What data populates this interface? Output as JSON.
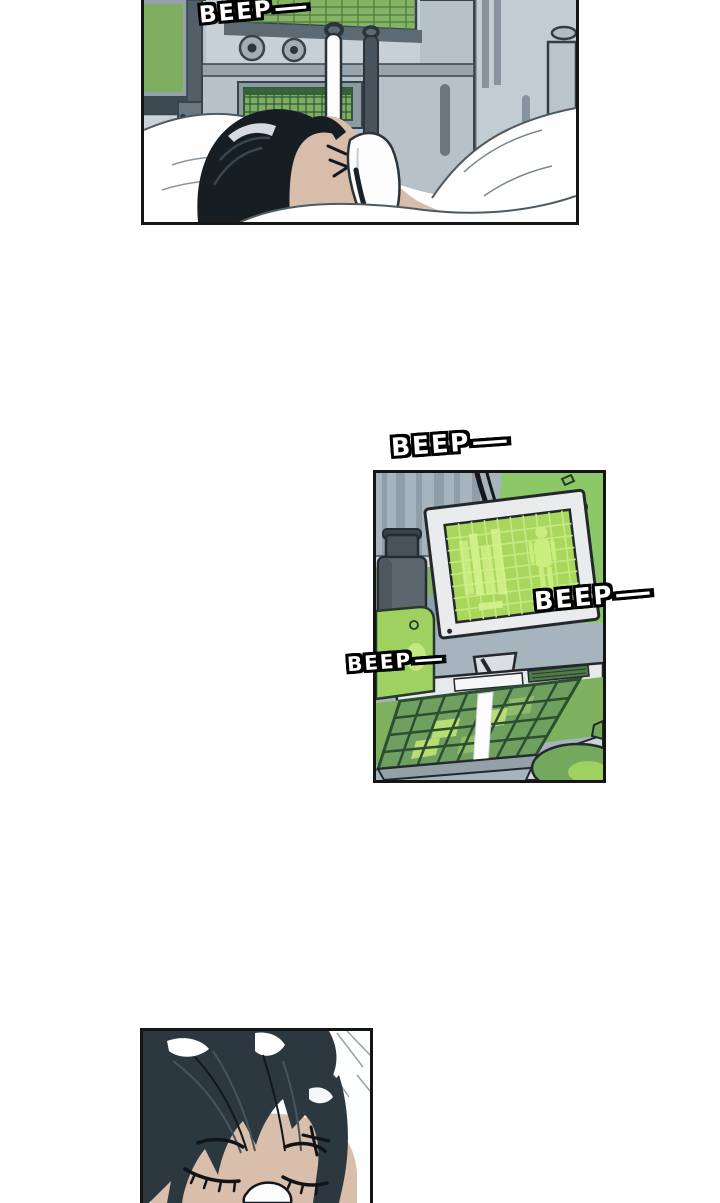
{
  "page": {
    "background": "#ffffff"
  },
  "sfx": {
    "beep1": {
      "text": "BEEP",
      "dash": "—"
    },
    "beep2": {
      "text": "BEEP",
      "dash": "—"
    },
    "beep3": {
      "text": "BEEP",
      "dash": "—"
    },
    "beep4": {
      "text": "BEEP",
      "dash": "—"
    }
  },
  "colors": {
    "page_bg": "#ffffff",
    "ink": "#151515",
    "sfx_fill": "#ffffff",
    "wall_gray": "#c8d2d8",
    "stripe_gray": "#a6b4be",
    "equip_gray": "#b6c1c9",
    "crt_green": "#85b464",
    "monitor_green_dim": "#7fae62",
    "screen_bright_green": "#a9d75e",
    "wall_green": "#8cc768",
    "counter_green": "#84b166",
    "desk_green": "#7db15e",
    "key_green": "#6fa05f",
    "container_green": "#9fd161",
    "hair_black": "#161d23",
    "hair_teal": "#2b3840",
    "skin": "#d7bdaa",
    "skin_soft": "#d8beab"
  }
}
